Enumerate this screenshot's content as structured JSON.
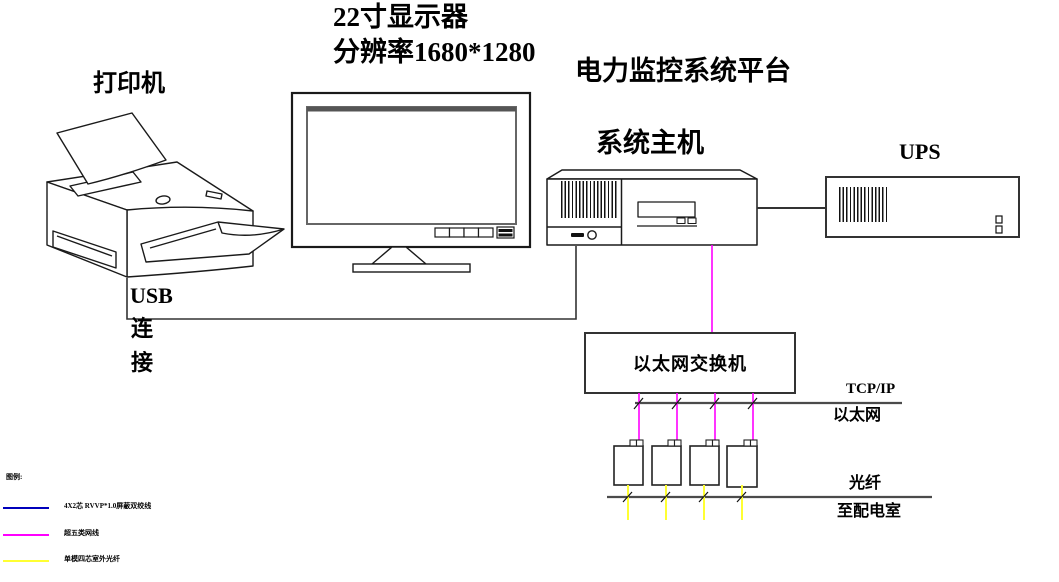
{
  "diagram": {
    "printer_label": "打印机",
    "monitor_label_line1": "22寸显示器",
    "monitor_label_line2": "分辨率1680*1280",
    "platform_label": "电力监控系统平台",
    "host_label": "系统主机",
    "ups_label": "UPS",
    "usb_label_line1": "USB",
    "usb_label_line2": "连",
    "usb_label_line3": "接",
    "switch_label": "以太网交换机",
    "ethernet_bus_label_top": "TCP/IP",
    "ethernet_bus_label_bottom": "以太网",
    "fiber_bus_label_top": "光纤",
    "fiber_bus_label_bottom": "至配电室"
  },
  "legend": {
    "header": "图例:",
    "items": [
      {
        "name": "shielded-twisted-pair-cable",
        "color": "#0000bb",
        "label": "4X2芯 RVVP*1.0屏蔽双绞线"
      },
      {
        "name": "cat5e-network-cable",
        "color": "#ff00ff",
        "label": "超五类网线"
      },
      {
        "name": "single-mode-outdoor-fiber",
        "color": "#ffff33",
        "label": "单模四芯室外光纤"
      }
    ]
  },
  "colors": {
    "network_cable_magenta": "#ff00ff",
    "fiber_cable_yellow": "#ffff33",
    "twisted_pair_blue": "#0000bb",
    "bus_line_gray": "#4b4b4b",
    "outline_black": "#000000",
    "background": "#ffffff"
  }
}
